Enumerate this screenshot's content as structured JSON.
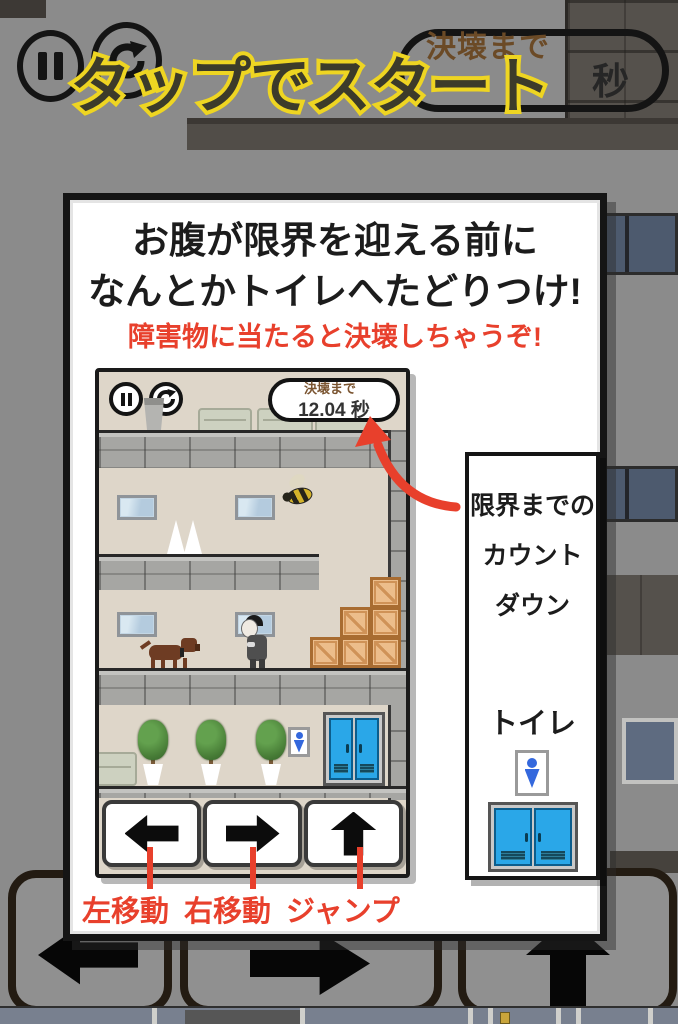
{
  "overlay": {
    "tap_to_start": "タップでスタート"
  },
  "hud": {
    "timer_label": "決壊まで",
    "timer_unit": "秒"
  },
  "card": {
    "heading_line1": "お腹が限界を迎える前に",
    "heading_line2": "なんとかトイレへたどりつけ!",
    "warning": "障害物に当たると決壊しちゃうぞ!",
    "mini": {
      "timer_label": "決壊まで",
      "timer_value": "12.04",
      "timer_unit": "秒"
    },
    "callout": {
      "line1": "限界までの",
      "line2": "カウント",
      "line3": "ダウン",
      "toilet_label": "トイレ"
    },
    "controls": {
      "left_label": "左移動",
      "right_label": "右移動",
      "jump_label": "ジャンプ"
    }
  },
  "colors": {
    "accent_red": "#e8402c",
    "accent_yellow": "#eed522",
    "door_blue": "#2aa7e8",
    "timer_brown": "#6b4a26"
  }
}
